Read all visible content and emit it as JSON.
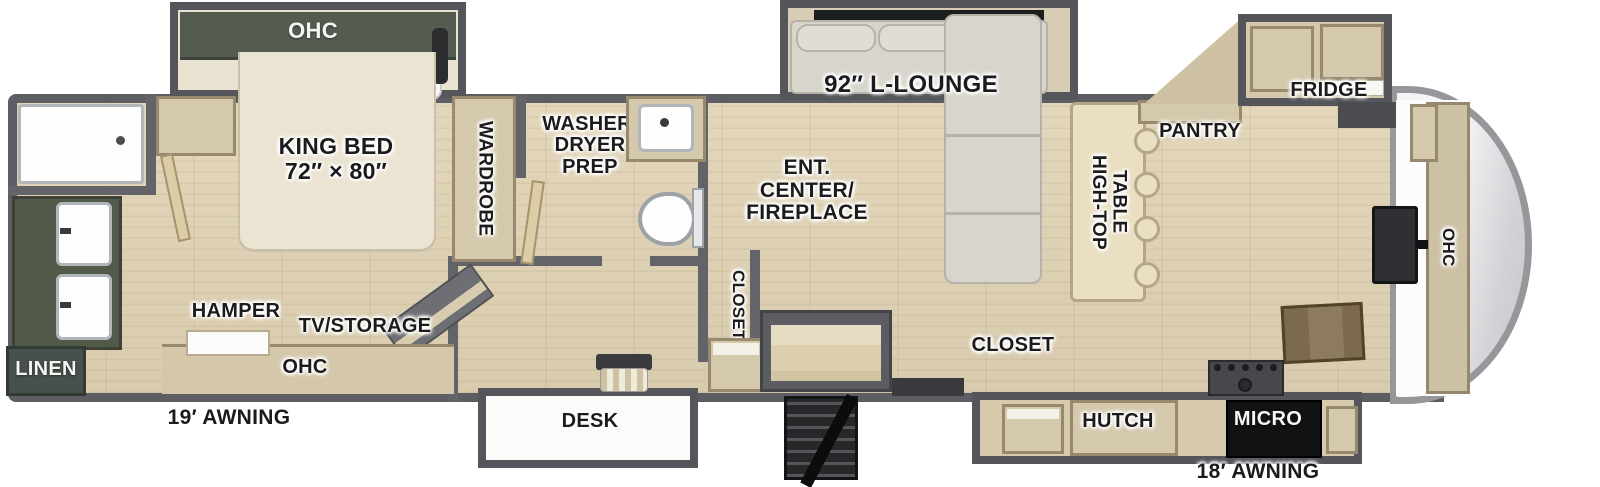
{
  "floorplan": {
    "bedroom": {
      "ohc": "OHC",
      "king_bed": "KING BED\n72″ × 80″",
      "wardrobe": "WARDROBE",
      "hamper": "HAMPER",
      "tv_storage": "TV/STORAGE",
      "ohc_lower": "OHC"
    },
    "bathroom": {
      "linen": "LINEN"
    },
    "laundry": {
      "washer_dryer_prep": "WASHER/\nDRYER\nPREP"
    },
    "hallway": {
      "closet": "CLOSET",
      "desk": "DESK"
    },
    "living": {
      "l_lounge": "92″ L-LOUNGE",
      "ent_center": "ENT.\nCENTER/\nFIREPLACE",
      "high_top_table": "HIGH-TOP\nTABLE"
    },
    "kitchen": {
      "pantry": "PANTRY",
      "fridge": "FRIDGE",
      "closet": "CLOSET",
      "hutch": "HUTCH",
      "micro": "MICRO",
      "ohc": "OHC"
    },
    "exterior": {
      "awning_rear": "19′ AWNING",
      "awning_front": "18′ AWNING"
    }
  },
  "colors": {
    "wall": "#63646a",
    "slide_wall": "#55565b",
    "floor_wood": "#ddd1b5",
    "cabinet_tan": "#d5c9ad",
    "cabinet_green": "#515948",
    "sofa": "#d8d5cc",
    "bed": "#ece4d2",
    "label_text": "#1b1b1d",
    "micro": "#121214",
    "front_cap": "#d2d3d6"
  }
}
